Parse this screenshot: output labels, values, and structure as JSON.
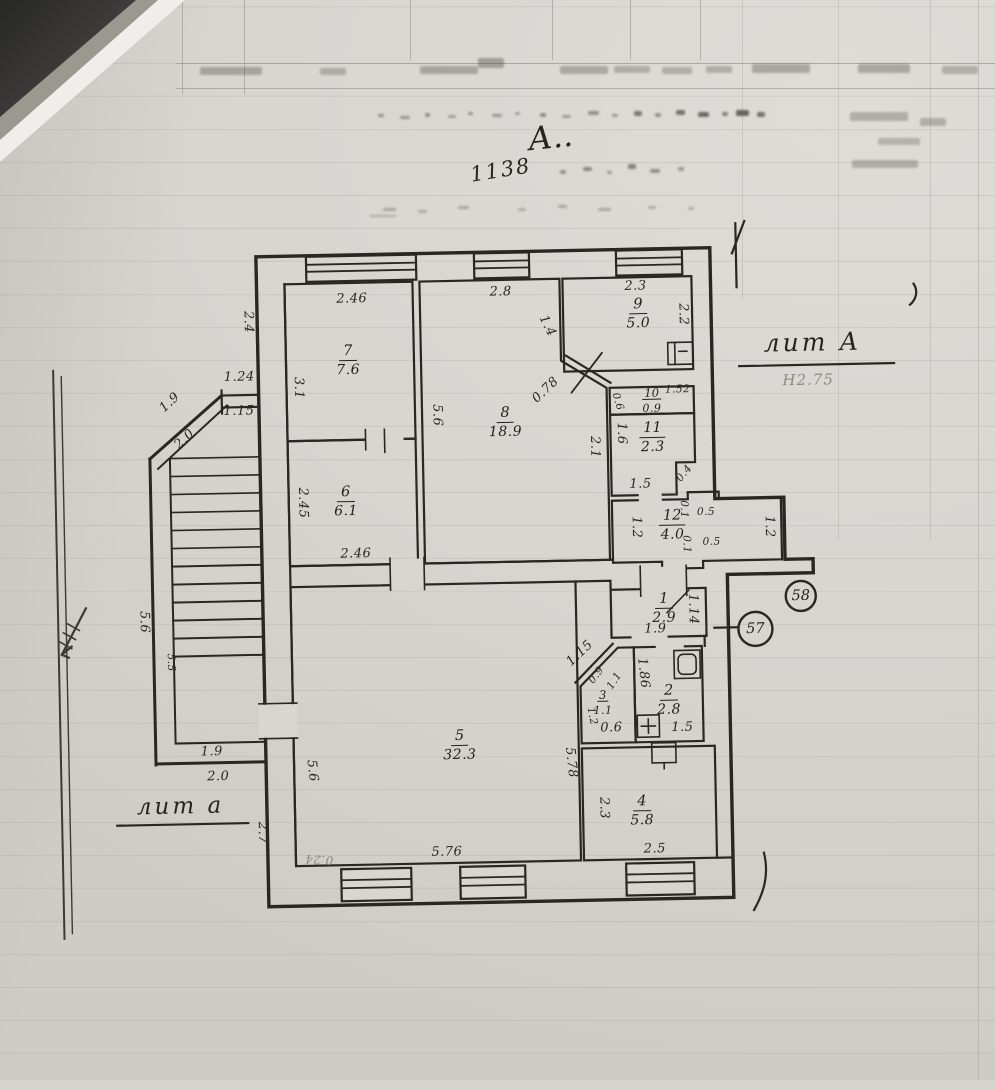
{
  "document": {
    "handwritten_mark": "А..",
    "inventory_number": "1138",
    "building_label": {
      "text": "лит А",
      "height_note": "Н2.75"
    },
    "annex_label": {
      "text": "лит а"
    },
    "parcel_circles": [
      {
        "text": "58"
      },
      {
        "text": "57"
      }
    ]
  },
  "rooms": [
    {
      "number": "7",
      "area": "7.6",
      "x": 352,
      "y": 357
    },
    {
      "number": "6",
      "area": "6.1",
      "x": 347,
      "y": 498
    },
    {
      "number": "8",
      "area": "18.9",
      "x": 508,
      "y": 422
    },
    {
      "number": "9",
      "area": "5.0",
      "x": 643,
      "y": 316
    },
    {
      "number": "10",
      "area": "0.9",
      "x": 655,
      "y": 402,
      "small": true
    },
    {
      "number": "11",
      "area": "2.3",
      "x": 655,
      "y": 440
    },
    {
      "number": "12",
      "area": "4.0",
      "x": 673,
      "y": 528
    },
    {
      "number": "1",
      "area": "2.9",
      "x": 663,
      "y": 611
    },
    {
      "number": "2",
      "area": "2.8",
      "x": 666,
      "y": 703
    },
    {
      "number": "3",
      "area": "1.1",
      "x": 600,
      "y": 703,
      "small": true
    },
    {
      "number": "4",
      "area": "5.8",
      "x": 637,
      "y": 813
    },
    {
      "number": "5",
      "area": "32.3",
      "x": 456,
      "y": 744
    }
  ],
  "dimensions": [
    {
      "text": "2.46",
      "x": 357,
      "y": 296,
      "rot": 0
    },
    {
      "text": "2.8",
      "x": 506,
      "y": 292,
      "rot": 0
    },
    {
      "text": "2.3",
      "x": 641,
      "y": 289,
      "rot": 0
    },
    {
      "text": "2.2",
      "x": 688,
      "y": 318,
      "rot": 90
    },
    {
      "text": "2.4",
      "x": 253,
      "y": 317,
      "rot": 90
    },
    {
      "text": "3.1",
      "x": 302,
      "y": 384,
      "rot": 90
    },
    {
      "text": "5.6",
      "x": 440,
      "y": 414,
      "rot": 90
    },
    {
      "text": "1.4",
      "x": 552,
      "y": 327,
      "rot": 65
    },
    {
      "text": "0.78",
      "x": 549,
      "y": 391,
      "rot": -42
    },
    {
      "text": "0.6",
      "x": 621,
      "y": 404,
      "rot": 75,
      "small": true
    },
    {
      "text": "1.52",
      "x": 681,
      "y": 393,
      "rot": 0,
      "small": true
    },
    {
      "text": "1.6",
      "x": 624,
      "y": 436,
      "rot": 90
    },
    {
      "text": "2.1",
      "x": 597,
      "y": 449,
      "rot": 90
    },
    {
      "text": "1.5",
      "x": 642,
      "y": 487,
      "rot": 0
    },
    {
      "text": "0.4",
      "x": 686,
      "y": 477,
      "rot": -50,
      "small": true
    },
    {
      "text": "2.45",
      "x": 304,
      "y": 499,
      "rot": 90
    },
    {
      "text": "2.46",
      "x": 356,
      "y": 551,
      "rot": 0
    },
    {
      "text": "1.24",
      "x": 243,
      "y": 372,
      "rot": 0
    },
    {
      "text": "1.15",
      "x": 242,
      "y": 406,
      "rot": 0
    },
    {
      "text": "1.9",
      "x": 173,
      "y": 396,
      "rot": -42
    },
    {
      "text": "2.0",
      "x": 187,
      "y": 433,
      "rot": -42
    },
    {
      "text": "5.6",
      "x": 143,
      "y": 615,
      "rot": 90
    },
    {
      "text": "5.5",
      "x": 169,
      "y": 656,
      "rot": 90,
      "small": true
    },
    {
      "text": "1.9",
      "x": 208,
      "y": 746,
      "rot": 0
    },
    {
      "text": "2.0",
      "x": 214,
      "y": 771,
      "rot": 0
    },
    {
      "text": "2.7",
      "x": 257,
      "y": 828,
      "rot": 90
    },
    {
      "text": "1.2",
      "x": 637,
      "y": 530,
      "rot": 90
    },
    {
      "text": "0.1",
      "x": 685,
      "y": 513,
      "rot": 90,
      "small": true
    },
    {
      "text": "0.5",
      "x": 707,
      "y": 516,
      "rot": 0,
      "small": true
    },
    {
      "text": "0.1",
      "x": 687,
      "y": 548,
      "rot": 90,
      "small": true
    },
    {
      "text": "0.5",
      "x": 712,
      "y": 546,
      "rot": 0,
      "small": true
    },
    {
      "text": "1.2",
      "x": 770,
      "y": 532,
      "rot": 90
    },
    {
      "text": "1.14",
      "x": 692,
      "y": 613,
      "rot": 90
    },
    {
      "text": "1.9",
      "x": 654,
      "y": 632,
      "rot": 0
    },
    {
      "text": "1.15",
      "x": 578,
      "y": 655,
      "rot": -42
    },
    {
      "text": "0.9",
      "x": 594,
      "y": 677,
      "rot": -52,
      "small": true
    },
    {
      "text": "1.1",
      "x": 612,
      "y": 683,
      "rot": -56,
      "small": true
    },
    {
      "text": "1.2",
      "x": 589,
      "y": 718,
      "rot": 80,
      "small": true
    },
    {
      "text": "0.6",
      "x": 608,
      "y": 730,
      "rot": 0
    },
    {
      "text": "1.86",
      "x": 641,
      "y": 676,
      "rot": 85
    },
    {
      "text": "1.5",
      "x": 679,
      "y": 731,
      "rot": 0
    },
    {
      "text": "2.3",
      "x": 599,
      "y": 810,
      "rot": 90
    },
    {
      "text": "2.5",
      "x": 649,
      "y": 852,
      "rot": 0
    },
    {
      "text": "5.78",
      "x": 567,
      "y": 764,
      "rot": 85
    },
    {
      "text": "5.6",
      "x": 308,
      "y": 767,
      "rot": 85
    },
    {
      "text": "5.76",
      "x": 441,
      "y": 851,
      "rot": 0
    },
    {
      "text": "0.24",
      "x": 313,
      "y": 856,
      "rot": 184,
      "pencil": true
    }
  ],
  "artifacts": {
    "noise": [
      [
        378,
        114,
        6,
        3,
        0.5
      ],
      [
        400,
        116,
        10,
        3,
        0.45
      ],
      [
        425,
        113,
        5,
        4,
        0.5
      ],
      [
        448,
        115,
        8,
        3,
        0.4
      ],
      [
        468,
        112,
        5,
        3,
        0.5
      ],
      [
        492,
        114,
        10,
        3,
        0.45
      ],
      [
        515,
        112,
        5,
        3,
        0.4
      ],
      [
        540,
        113,
        6,
        4,
        0.55
      ],
      [
        562,
        115,
        9,
        3,
        0.4
      ],
      [
        588,
        111,
        11,
        4,
        0.5
      ],
      [
        612,
        114,
        6,
        3,
        0.45
      ],
      [
        634,
        111,
        8,
        5,
        0.65
      ],
      [
        655,
        113,
        6,
        4,
        0.5
      ],
      [
        676,
        110,
        9,
        5,
        0.7
      ],
      [
        698,
        112,
        11,
        5,
        0.75
      ],
      [
        722,
        112,
        6,
        4,
        0.6
      ],
      [
        736,
        110,
        13,
        6,
        0.8
      ],
      [
        757,
        112,
        8,
        5,
        0.7
      ],
      [
        560,
        170,
        6,
        4,
        0.5
      ],
      [
        583,
        167,
        9,
        4,
        0.55
      ],
      [
        607,
        171,
        5,
        3,
        0.45
      ],
      [
        628,
        164,
        8,
        5,
        0.6
      ],
      [
        650,
        169,
        10,
        4,
        0.5
      ],
      [
        678,
        167,
        6,
        4,
        0.45
      ],
      [
        383,
        208,
        13,
        3,
        0.35
      ],
      [
        418,
        210,
        9,
        3,
        0.3
      ],
      [
        458,
        206,
        11,
        3,
        0.35
      ],
      [
        518,
        208,
        8,
        3,
        0.3
      ],
      [
        558,
        205,
        9,
        3,
        0.35
      ],
      [
        598,
        208,
        13,
        3,
        0.35
      ],
      [
        648,
        206,
        8,
        3,
        0.3
      ],
      [
        688,
        207,
        6,
        3,
        0.3
      ],
      [
        370,
        215,
        26,
        2,
        0.3
      ],
      [
        850,
        112,
        58,
        9,
        0.3
      ],
      [
        878,
        138,
        42,
        7,
        0.28
      ],
      [
        852,
        160,
        66,
        8,
        0.3
      ],
      [
        920,
        118,
        26,
        8,
        0.3
      ],
      [
        200,
        67,
        62,
        8,
        0.35
      ],
      [
        320,
        68,
        26,
        7,
        0.3
      ],
      [
        420,
        66,
        58,
        8,
        0.35
      ],
      [
        478,
        58,
        26,
        10,
        0.4
      ],
      [
        560,
        66,
        48,
        8,
        0.33
      ],
      [
        614,
        66,
        36,
        7,
        0.3
      ],
      [
        662,
        67,
        30,
        7,
        0.3
      ],
      [
        706,
        66,
        26,
        7,
        0.3
      ],
      [
        752,
        64,
        58,
        9,
        0.35
      ],
      [
        858,
        64,
        52,
        9,
        0.35
      ],
      [
        942,
        66,
        36,
        8,
        0.3
      ]
    ]
  }
}
